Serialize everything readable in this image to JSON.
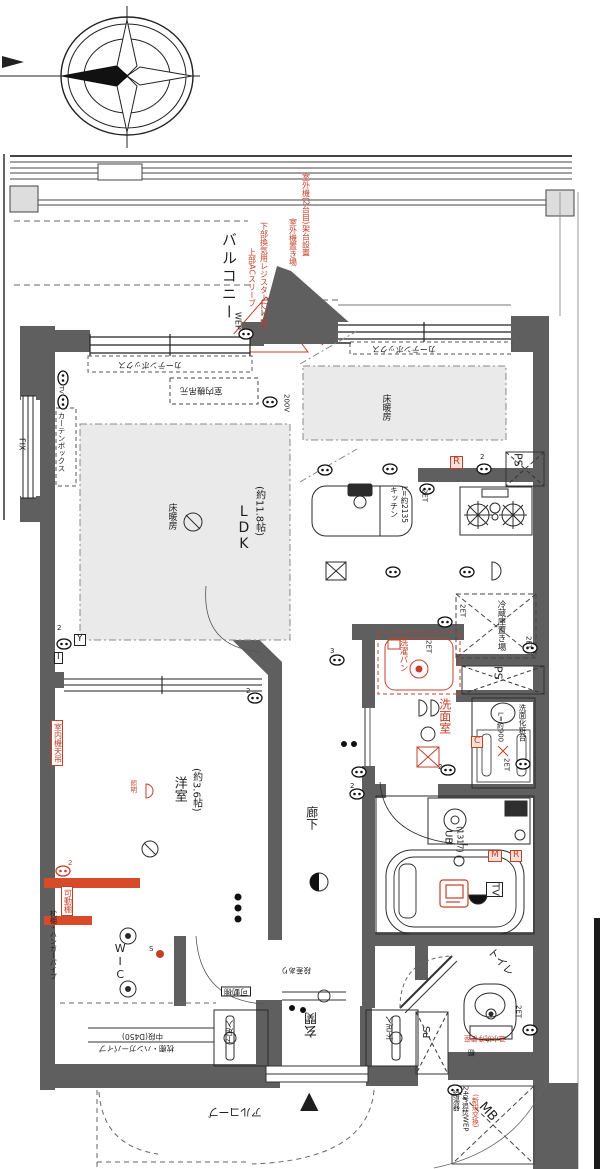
{
  "plan_meta": {
    "type": "apartment-floor-plan",
    "accent_red": "#c4402a",
    "wall_gray": "#5f5f5f",
    "floor_heating_gray": "#eaeaea"
  },
  "labels": [
    {
      "n": "balcony-label",
      "t": "バルコニー",
      "x": 220,
      "y": 232,
      "c": "v sp2",
      "s": 15
    },
    {
      "n": "wep-balcony-label",
      "t": "WEP",
      "x": 233,
      "y": 312,
      "c": "v",
      "s": 8
    },
    {
      "n": "ac-sleeve-note",
      "t": "上部ACスリーブ",
      "x": 247,
      "y": 248,
      "c": "v red",
      "s": 8
    },
    {
      "n": "vent-register-note",
      "t": "下部換気用レジスター(2ヶ所)",
      "x": 259,
      "y": 222,
      "c": "v red",
      "s": 8
    },
    {
      "n": "outdoor-unit-note",
      "t": "室外機置き場",
      "x": 288,
      "y": 218,
      "c": "v red",
      "s": 8
    },
    {
      "n": "outdoor-unit2-note",
      "t": "室外機(2台目)架台設置",
      "x": 301,
      "y": 173,
      "c": "v red",
      "s": 8
    },
    {
      "n": "fix-window-label",
      "t": "FIX",
      "x": 17,
      "y": 438,
      "c": "v",
      "s": 8
    },
    {
      "n": "curtain-box-left",
      "t": "カーテンボックス",
      "x": 57,
      "y": 412,
      "c": "v",
      "s": 7.5
    },
    {
      "n": "curtain-box-top",
      "t": "カーテンボックス",
      "x": 118,
      "y": 360,
      "c": "h180",
      "s": 8
    },
    {
      "n": "curtain-box-kitchen",
      "t": "カーテンボックス",
      "x": 372,
      "y": 344,
      "c": "h180",
      "s": 8
    },
    {
      "n": "indoor-unit-ldk-note",
      "t": "室内機吊元",
      "x": 180,
      "y": 385,
      "c": "h180",
      "s": 8.5
    },
    {
      "n": "outlet-200v-label",
      "t": "200V",
      "x": 282,
      "y": 394,
      "c": "v",
      "s": 7
    },
    {
      "n": "floor-heating-ldk-label",
      "t": "床暖房",
      "x": 166,
      "y": 503,
      "c": "v",
      "s": 9
    },
    {
      "n": "floor-heating-kitchen-label",
      "t": "床暖房",
      "x": 380,
      "y": 394,
      "c": "v",
      "s": 9
    },
    {
      "n": "ldk-name",
      "t": "LDK",
      "x": 236,
      "y": 504,
      "c": "vu",
      "s": 14
    },
    {
      "n": "ldk-size",
      "t": "(約11.8帖)",
      "x": 253,
      "y": 486,
      "c": "v",
      "s": 10
    },
    {
      "n": "kitchen-name",
      "t": "キッチン",
      "x": 389,
      "y": 486,
      "c": "v",
      "s": 8
    },
    {
      "n": "kitchen-size",
      "t": "L=約2135",
      "x": 400,
      "y": 486,
      "c": "v",
      "s": 7.5
    },
    {
      "n": "r-outlet-box-1",
      "t": "R",
      "x": 450,
      "y": 456,
      "c": "rbx",
      "s": 10
    },
    {
      "n": "ps-label-1",
      "t": "PS",
      "x": 512,
      "y": 453,
      "c": "v",
      "s": 11
    },
    {
      "n": "fridge-space-label",
      "t": "冷蔵庫置き場",
      "x": 496,
      "y": 600,
      "c": "v",
      "s": 8.5
    },
    {
      "n": "et-label-1",
      "t": "2ET",
      "x": 420,
      "y": 489,
      "c": "v",
      "s": 7
    },
    {
      "n": "et-label-2",
      "t": "2ET",
      "x": 458,
      "y": 604,
      "c": "v",
      "s": 7
    },
    {
      "n": "et-label-3",
      "t": "2ET",
      "x": 524,
      "y": 636,
      "c": "v",
      "s": 7
    },
    {
      "n": "et-label-4",
      "t": "2ET",
      "x": 424,
      "y": 640,
      "c": "v",
      "s": 7
    },
    {
      "n": "et-label-5",
      "t": "2ET",
      "x": 502,
      "y": 758,
      "c": "v",
      "s": 7
    },
    {
      "n": "et-label-6",
      "t": "2ET",
      "x": 514,
      "y": 1005,
      "c": "v",
      "s": 7
    },
    {
      "n": "washer-pan-label",
      "t": "洗濯パン",
      "x": 398,
      "y": 638,
      "c": "v red",
      "s": 8.5
    },
    {
      "n": "ps-label-2",
      "t": "PS",
      "x": 492,
      "y": 666,
      "c": "v",
      "s": 11
    },
    {
      "n": "washroom-label",
      "t": "洗面室",
      "x": 438,
      "y": 698,
      "c": "v red",
      "s": 12
    },
    {
      "n": "vanity-label",
      "t": "洗面化粧台",
      "x": 518,
      "y": 704,
      "c": "v",
      "s": 7.5
    },
    {
      "n": "vanity-size",
      "t": "L=約900",
      "x": 496,
      "y": 712,
      "c": "v",
      "s": 7
    },
    {
      "n": "c-outlet-box",
      "t": "C",
      "x": 471,
      "y": 736,
      "c": "rbx",
      "s": 9
    },
    {
      "n": "unit-bath-label",
      "t": "UB",
      "x": 442,
      "y": 830,
      "c": "v",
      "s": 10
    },
    {
      "n": "unit-bath-size",
      "t": "(1317)",
      "x": 455,
      "y": 826,
      "c": "v",
      "s": 8
    },
    {
      "n": "m-outlet-box",
      "t": "M",
      "x": 488,
      "y": 850,
      "c": "rbx",
      "s": 9
    },
    {
      "n": "r-outlet-box-2",
      "t": "R",
      "x": 510,
      "y": 850,
      "c": "rbx",
      "s": 9
    },
    {
      "n": "bath-tv-label",
      "t": "TV",
      "x": 486,
      "y": 882,
      "c": "bx v",
      "s": 10
    },
    {
      "n": "hallway-label",
      "t": "廊下",
      "x": 305,
      "y": 806,
      "c": "v",
      "s": 12
    },
    {
      "n": "western-room-label",
      "t": "洋室",
      "x": 172,
      "y": 776,
      "c": "v",
      "s": 13
    },
    {
      "n": "western-room-size",
      "t": "(約3.6帖)",
      "x": 190,
      "y": 768,
      "c": "v",
      "s": 10
    },
    {
      "n": "indoor-unit-west-note",
      "t": "室内機天吊",
      "x": 51,
      "y": 720,
      "c": "v red obx",
      "s": 8
    },
    {
      "n": "light-note",
      "t": "照明",
      "x": 129,
      "y": 780,
      "c": "v red",
      "s": 6.5
    },
    {
      "n": "movable-shelf-note-1",
      "t": "可動棚",
      "x": 61,
      "y": 886,
      "c": "v red obx",
      "s": 8
    },
    {
      "n": "shelf-hanger-pipe-label",
      "t": "枕棚・ハンガーパイプ",
      "x": 49,
      "y": 910,
      "c": "v",
      "s": 7
    },
    {
      "n": "wic-label",
      "t": "WIC",
      "x": 114,
      "y": 942,
      "c": "vu",
      "s": 11
    },
    {
      "n": "switch-s-label",
      "t": "S",
      "x": 149,
      "y": 946,
      "c": "",
      "s": 7
    },
    {
      "n": "middle-shelf-label-1",
      "t": "枕棚・ハンガーパイプ",
      "x": 99,
      "y": 1044,
      "c": "h180",
      "s": 7.5
    },
    {
      "n": "middle-shelf-label-2",
      "t": "中段(D450)",
      "x": 122,
      "y": 1032,
      "c": "h180",
      "s": 7.5
    },
    {
      "n": "shoe-box-left-label",
      "t": "下足入",
      "x": 226,
      "y": 1020,
      "c": "v180",
      "s": 8
    },
    {
      "n": "movable-shelf-note-2",
      "t": "可動棚",
      "x": 221,
      "y": 986,
      "c": "h180 bx",
      "s": 8
    },
    {
      "n": "step-note",
      "t": "段差あり",
      "x": 281,
      "y": 966,
      "c": "h180",
      "s": 7.5
    },
    {
      "n": "entrance-label",
      "t": "玄関",
      "x": 306,
      "y": 1012,
      "c": "v180",
      "s": 13
    },
    {
      "n": "shoe-box-right-label",
      "t": "下足入",
      "x": 386,
      "y": 1016,
      "c": "v180",
      "s": 8
    },
    {
      "n": "ps-label-3",
      "t": "PS",
      "x": 423,
      "y": 1026,
      "c": "v180",
      "s": 10
    },
    {
      "n": "alcove-label",
      "t": "アルコーブ",
      "x": 208,
      "y": 1106,
      "c": "h180",
      "s": 11
    },
    {
      "n": "entrance-direction-mark",
      "t": "▲",
      "x": 300,
      "y": 1088,
      "c": "",
      "s": 24
    },
    {
      "n": "toilet-label",
      "t": "トイレ",
      "x": 494,
      "y": 946,
      "c": "diag",
      "s": 11
    },
    {
      "n": "toilet-note",
      "t": "温水洗浄便座",
      "x": 464,
      "y": 1034,
      "c": "h180 red",
      "s": 7
    },
    {
      "n": "shelf-label",
      "t": "棚",
      "x": 468,
      "y": 1048,
      "c": "h180",
      "s": 7
    },
    {
      "n": "meter-box-label",
      "t": "MB",
      "x": 486,
      "y": 1100,
      "c": "diag",
      "s": 13
    },
    {
      "n": "water-heater-label-1",
      "t": "給湯器",
      "x": 452,
      "y": 1090,
      "c": "v",
      "s": 7
    },
    {
      "n": "water-heater-label-2",
      "t": "24号追焚WEP",
      "x": 461,
      "y": 1086,
      "c": "v",
      "s": 7
    },
    {
      "n": "water-heater-label-3",
      "t": "(新規交換)",
      "x": 471,
      "y": 1094,
      "c": "v red",
      "s": 7
    },
    {
      "n": "y-outlet-box",
      "t": "Y",
      "x": 74,
      "y": 634,
      "c": "bx",
      "s": 9
    },
    {
      "n": "i-outlet-box",
      "t": "I",
      "x": 54,
      "y": 652,
      "c": "bx",
      "s": 9
    },
    {
      "n": "tv-outlet-label",
      "t": "TV",
      "x": 57,
      "y": 386,
      "c": "v",
      "s": 6
    },
    {
      "n": "count-2a",
      "t": "2",
      "x": 68,
      "y": 860,
      "c": "red",
      "s": 7
    },
    {
      "n": "count-2b",
      "t": "2",
      "x": 57,
      "y": 625,
      "c": "",
      "s": 7
    },
    {
      "n": "count-2c",
      "t": "2",
      "x": 246,
      "y": 688,
      "c": "",
      "s": 7
    },
    {
      "n": "count-2d",
      "t": "2",
      "x": 480,
      "y": 454,
      "c": "",
      "s": 7
    },
    {
      "n": "count-2e",
      "t": "2",
      "x": 350,
      "y": 783,
      "c": "",
      "s": 7
    },
    {
      "n": "count-2f",
      "t": "2",
      "x": 438,
      "y": 764,
      "c": "",
      "s": 7
    },
    {
      "n": "count-3a",
      "t": "3",
      "x": 330,
      "y": 648,
      "c": "",
      "s": 7
    }
  ]
}
